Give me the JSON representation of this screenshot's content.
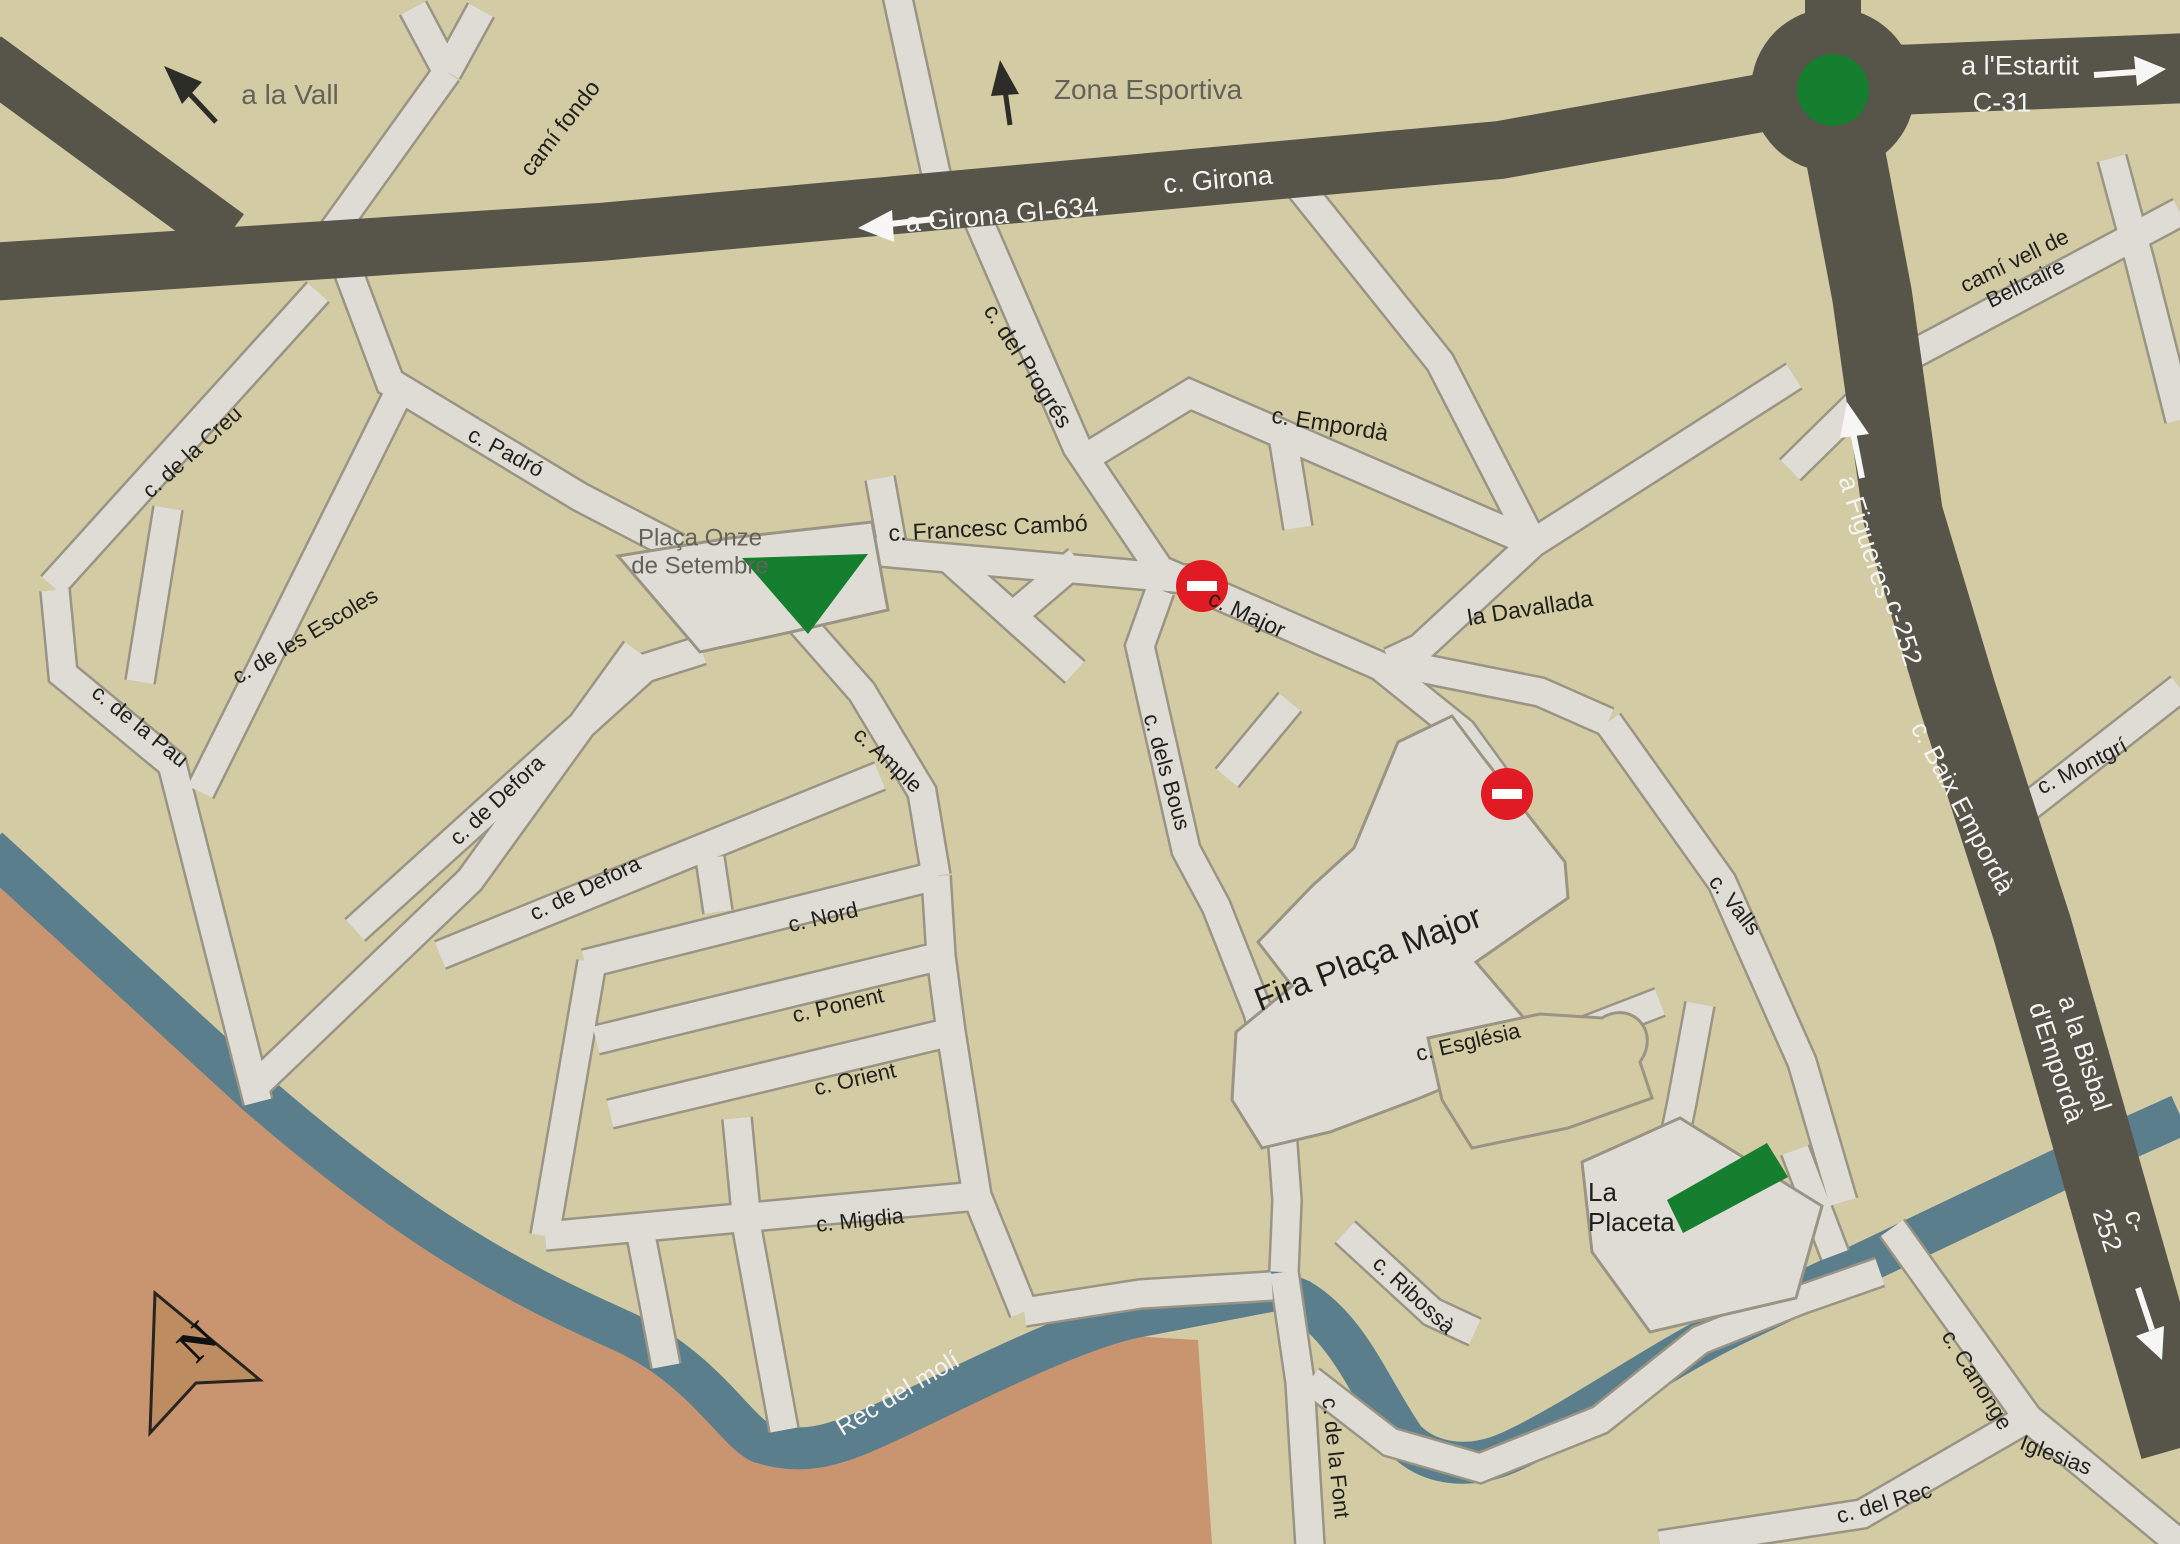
{
  "map": {
    "compass": {
      "label": "N"
    },
    "colors": {
      "bg": "#d3cba3",
      "street_fill": "#dfdcd6",
      "street_casing": "#9a9484",
      "road": "#57544a",
      "river": "#5b7e8d",
      "flood_brown": "#c99470",
      "park_green": "#157e2f",
      "no_entry_red": "#e01b23",
      "compass_fill": "#bd8c60",
      "label_dark": "#1f1f1c",
      "label_gray": "#63625a",
      "label_white": "#f4f4f2"
    },
    "no_entry_signs": [
      {
        "x": 1202,
        "y": 586
      },
      {
        "x": 1507,
        "y": 794
      }
    ],
    "labels": [
      {
        "id": "a-la-vall",
        "text": "a la Vall",
        "x": 290,
        "y": 95,
        "rot": 0,
        "color": "gray",
        "size": 28
      },
      {
        "id": "cami-fondo",
        "text": "camí fondo",
        "x": 560,
        "y": 128,
        "rot": -52,
        "color": "dark",
        "size": 23
      },
      {
        "id": "zona-esportiva",
        "text": "Zona Esportiva",
        "x": 1148,
        "y": 90,
        "rot": 0,
        "color": "gray",
        "size": 28
      },
      {
        "id": "a-girona-gi-634",
        "text": "a Girona GI-634",
        "x": 1002,
        "y": 215,
        "rot": -5,
        "color": "white",
        "size": 27
      },
      {
        "id": "c-girona",
        "text": "c. Girona",
        "x": 1218,
        "y": 180,
        "rot": -5,
        "color": "white",
        "size": 27
      },
      {
        "id": "a-l-estartit",
        "text": "a l'Estartit",
        "x": 2020,
        "y": 66,
        "rot": 0,
        "color": "white",
        "size": 27
      },
      {
        "id": "c-31",
        "text": "C-31",
        "x": 2002,
        "y": 103,
        "rot": 0,
        "color": "white",
        "size": 27
      },
      {
        "id": "cami-vell-de-bellcaire",
        "text": "camí vell de Bellcaire",
        "x": 2020,
        "y": 272,
        "rot": -26,
        "color": "dark",
        "size": 22
      },
      {
        "id": "a-figueres",
        "text": "a Figueres",
        "x": 1866,
        "y": 537,
        "rot": 72,
        "color": "white",
        "size": 27
      },
      {
        "id": "c-252-upper",
        "text": "c-252",
        "x": 1903,
        "y": 633,
        "rot": 72,
        "color": "white",
        "size": 27
      },
      {
        "id": "c-del-progres",
        "text": "c. del Progrés",
        "x": 1028,
        "y": 366,
        "rot": 57,
        "color": "dark",
        "size": 23
      },
      {
        "id": "c-emporda",
        "text": "c. Empordà",
        "x": 1330,
        "y": 424,
        "rot": 9,
        "color": "dark",
        "size": 23
      },
      {
        "id": "c-francesc-cambo",
        "text": "c. Francesc  Cambó",
        "x": 988,
        "y": 528,
        "rot": -3,
        "color": "dark",
        "size": 23
      },
      {
        "id": "placa-onze-de-setembre",
        "text": "Plaça Onze\nde Setembre",
        "x": 700,
        "y": 552,
        "rot": 0,
        "color": "gray",
        "size": 24
      },
      {
        "id": "c-major",
        "text": "c. Major",
        "x": 1247,
        "y": 614,
        "rot": 25,
        "color": "dark",
        "size": 23
      },
      {
        "id": "la-davallada",
        "text": "la Davallada",
        "x": 1530,
        "y": 608,
        "rot": -9,
        "color": "dark",
        "size": 23
      },
      {
        "id": "c-de-la-creu",
        "text": "c. de la  Creu",
        "x": 192,
        "y": 452,
        "rot": -42,
        "color": "dark",
        "size": 22
      },
      {
        "id": "c-padro",
        "text": "c. Padró",
        "x": 506,
        "y": 452,
        "rot": 28,
        "color": "dark",
        "size": 22
      },
      {
        "id": "c-de-les-escoles",
        "text": "c. de les Escoles",
        "x": 305,
        "y": 636,
        "rot": -31,
        "color": "dark",
        "size": 22
      },
      {
        "id": "c-de-la-pau",
        "text": "c. de la  Pau",
        "x": 140,
        "y": 726,
        "rot": 39,
        "color": "dark",
        "size": 22
      },
      {
        "id": "c-de-defora-1",
        "text": "c. de Defora",
        "x": 497,
        "y": 800,
        "rot": -43,
        "color": "dark",
        "size": 22
      },
      {
        "id": "c-de-defora-2",
        "text": "c. de Defora",
        "x": 585,
        "y": 888,
        "rot": -26,
        "color": "dark",
        "size": 22
      },
      {
        "id": "c-ample",
        "text": "c. Ample",
        "x": 888,
        "y": 760,
        "rot": 43,
        "color": "dark",
        "size": 22
      },
      {
        "id": "c-dels-bous",
        "text": "c. dels Bous",
        "x": 1167,
        "y": 772,
        "rot": 74,
        "color": "dark",
        "size": 22
      },
      {
        "id": "c-nord",
        "text": "c. Nord",
        "x": 823,
        "y": 917,
        "rot": -13,
        "color": "dark",
        "size": 22
      },
      {
        "id": "c-ponent",
        "text": "c. Ponent",
        "x": 838,
        "y": 1005,
        "rot": -13,
        "color": "dark",
        "size": 22
      },
      {
        "id": "c-orient",
        "text": "c. Orient",
        "x": 855,
        "y": 1079,
        "rot": -13,
        "color": "dark",
        "size": 22
      },
      {
        "id": "fira-placa-major",
        "text": "Fira Plaça  Major",
        "x": 1368,
        "y": 958,
        "rot": -21,
        "color": "dark",
        "size": 33
      },
      {
        "id": "c-valls",
        "text": "c. Valls",
        "x": 1735,
        "y": 905,
        "rot": 52,
        "color": "dark",
        "size": 22
      },
      {
        "id": "c-esglesia",
        "text": "c. Església",
        "x": 1468,
        "y": 1042,
        "rot": -13,
        "color": "dark",
        "size": 22
      },
      {
        "id": "c-montgri",
        "text": "c. Montgrí",
        "x": 2082,
        "y": 766,
        "rot": -27,
        "color": "dark",
        "size": 22
      },
      {
        "id": "c-baix-emporda",
        "text": "c. Baix Empordà",
        "x": 1962,
        "y": 808,
        "rot": 62,
        "color": "white",
        "size": 26
      },
      {
        "id": "a-la-bisbal-d-emporda",
        "text": "a la Bisbal  d'Empordà",
        "x": 2070,
        "y": 1058,
        "rot": 72,
        "color": "white",
        "size": 26
      },
      {
        "id": "c-252-lower",
        "text": "c-252",
        "x": 2121,
        "y": 1226,
        "rot": 72,
        "color": "white",
        "size": 26
      },
      {
        "id": "la-placeta",
        "text": "La\nPlaceta",
        "x": 1588,
        "y": 1208,
        "rot": 0,
        "color": "dark",
        "size": 26,
        "align": "left"
      },
      {
        "id": "c-ribossa",
        "text": "c. Ribossà",
        "x": 1414,
        "y": 1295,
        "rot": 43,
        "color": "dark",
        "size": 22
      },
      {
        "id": "c-migdia",
        "text": "c. Migdia",
        "x": 860,
        "y": 1220,
        "rot": -6,
        "color": "dark",
        "size": 22
      },
      {
        "id": "rec-del-moli",
        "text": "Rec del molí",
        "x": 898,
        "y": 1394,
        "rot": -31,
        "color": "white",
        "size": 25
      },
      {
        "id": "c-de-la-font",
        "text": "c. de la  Font",
        "x": 1336,
        "y": 1458,
        "rot": 84,
        "color": "dark",
        "size": 22
      },
      {
        "id": "c-canonge",
        "text": "c. Canonge",
        "x": 1977,
        "y": 1380,
        "rot": 58,
        "color": "dark",
        "size": 22
      },
      {
        "id": "iglesias",
        "text": "Iglesias",
        "x": 2056,
        "y": 1455,
        "rot": 21,
        "color": "dark",
        "size": 22
      },
      {
        "id": "c-del-rec",
        "text": "c. del  Rec",
        "x": 1884,
        "y": 1503,
        "rot": -16,
        "color": "dark",
        "size": 22
      }
    ]
  }
}
